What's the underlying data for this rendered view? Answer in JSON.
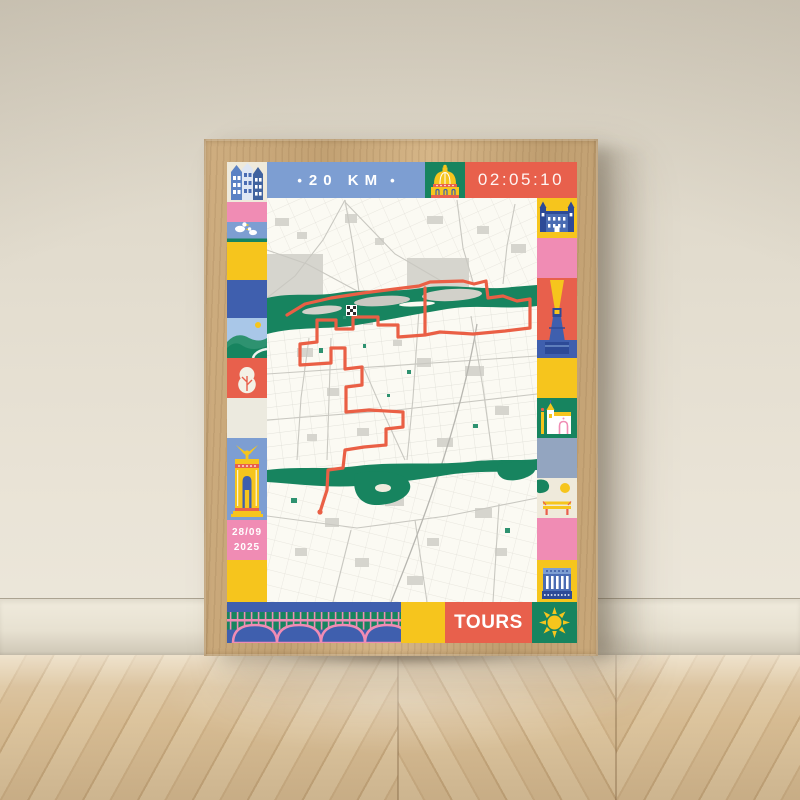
{
  "poster": {
    "distance_banner": {
      "bullet": "•",
      "label": "20 KM"
    },
    "finish_time": "02:05:10",
    "event_date": {
      "line1": "28/09",
      "line2": "2025"
    },
    "city_name": "TOURS"
  },
  "palette": {
    "banner_blue": "#7d9ed2",
    "navy": "#3f5fae",
    "yellow": "#f6c51d",
    "orange_red": "#e8604c",
    "pink": "#f08cb4",
    "green": "#17845f",
    "cream": "#efeadb",
    "slate_blue": "#93a5c0",
    "map_background": "#fbfaf3",
    "route_orange": "#ea5f45",
    "frame_oak": "#c7a678"
  },
  "border_tiles": {
    "top_row": [
      "houses",
      "distance-banner",
      "dome",
      "finish-time"
    ],
    "left_column": [
      "houses",
      "ducks",
      "yellow-plain",
      "navy-plain",
      "riverbank",
      "tree",
      "cream-plain",
      "fountain-gate",
      "event-date",
      "yellow-plain"
    ],
    "right_column": [
      "chateau",
      "pink-plain",
      "lighthouse",
      "yellow-plain",
      "cathedral",
      "slate-plain",
      "park-bench",
      "pink-plain",
      "columned-building"
    ],
    "bottom_row": [
      "arched-bridge",
      "yellow-plain",
      "city-name",
      "sun"
    ]
  },
  "map": {
    "markers": [
      "finish-flag"
    ]
  }
}
